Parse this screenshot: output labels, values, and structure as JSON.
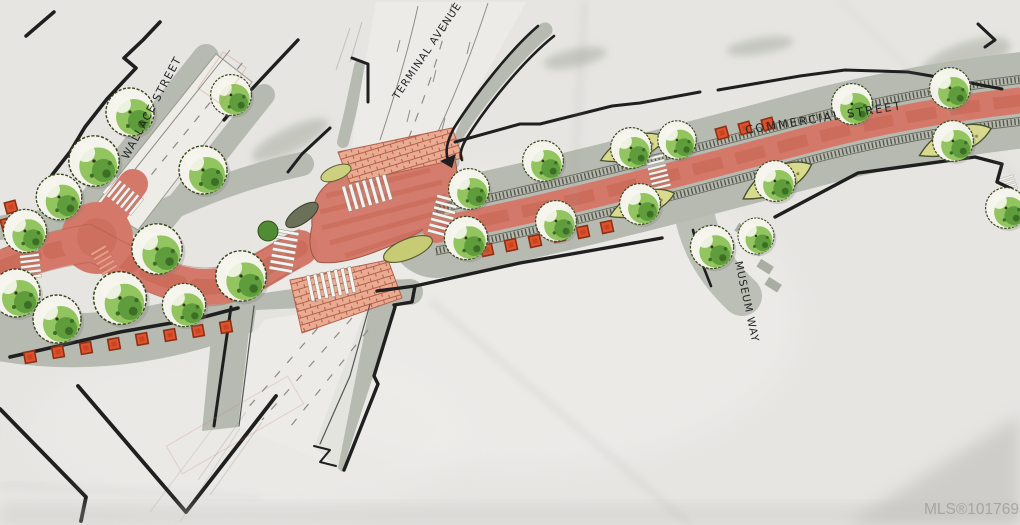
{
  "labels": {
    "wallace": "WALLACE STREET",
    "terminal": "TERMINAL AVENUE",
    "commercial": "COMMERCIAL STREET",
    "museum": "MUSEUM WAY"
  },
  "watermark": "MLS®1017695",
  "palette": {
    "paper": "#e6e5e2",
    "ink": "#1f1f1f",
    "sidewalk_gray": "#b6bab0",
    "road_red": "#d4796a",
    "road_red_dark": "#c4604c",
    "brick_pink": "#e9ab92",
    "tree_green": "#8cc257",
    "tree_green_dark": "#5f9c3c",
    "planter_olive": "#c6cb74",
    "bench_red": "#dd5330",
    "watermark_gray": "#a4a4a1"
  }
}
